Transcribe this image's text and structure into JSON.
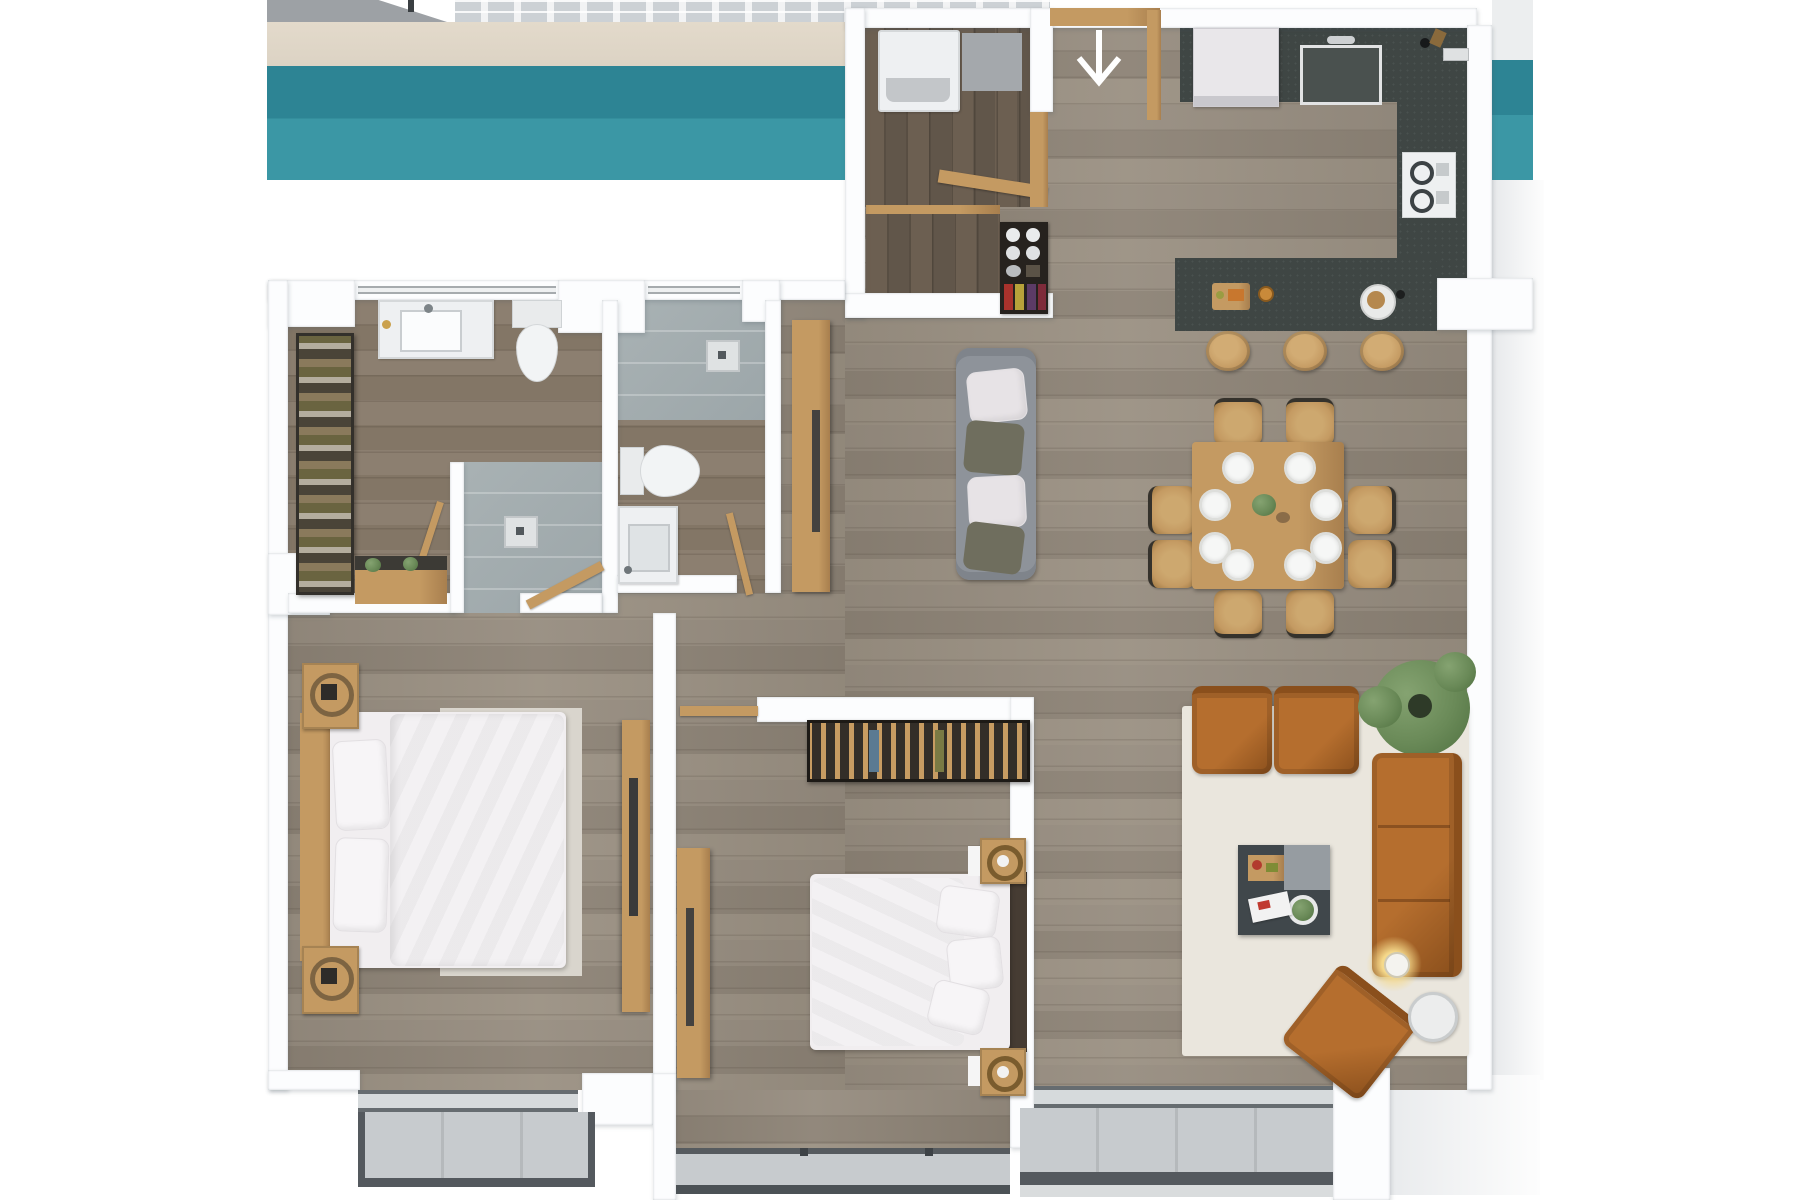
{
  "page": {
    "kind": "3d-apartment-floor-plan-render",
    "visible_text": "",
    "background": "#ffffff"
  },
  "palette": {
    "wall": "#fcfdfe",
    "teal_top": "#2d8494",
    "teal_bottom": "#3b97a5",
    "beige": "#dcd3c4",
    "slab_grey": "#9da1a5",
    "tile_a": "#ccd1d5",
    "tile_b": "#f2f3f4",
    "floor_a": "#968c7f",
    "floor_b": "#8c8275",
    "floor_c": "#9a9082",
    "floor_dark_a": "#6c5f51",
    "floor_dark_b": "#61564a",
    "bath_a": "#8c7f70",
    "bath_b": "#837666",
    "shower": "#a9b2b4",
    "counter": "#3f4644",
    "wood_tan": "#c49a62",
    "wood_tan_dark": "#a87f4e",
    "leather": "#b56e2e",
    "leather_dark": "#8a4f1c",
    "sofa_grey": "#8e939a",
    "cushion_olive": "#6f6e5e",
    "cushion_white": "#e7e3e6",
    "rug_living": "#eae6dd",
    "rug_bed": "#d9d5cd",
    "bedding": "#f1eef0",
    "pillow": "#f7f5f7",
    "fixture": "#eef0f2",
    "fixture_edge": "#d5d8da",
    "balcony": "#c7cbce",
    "frame_dark": "#54595e",
    "glow": "#f5d98b",
    "plant": "#6a8a58",
    "plant_dark": "#4f7040",
    "headboard": "#463c33",
    "closet_dark": "#26221e",
    "appliance": "#e9e7ea",
    "mat_grey": "#a4a8ac",
    "handle_dark": "#44423f",
    "outside_grey": "#e9ebed"
  },
  "entry": {
    "arrow_direction": "down"
  },
  "rooms": [
    {
      "id": "terrace-strip",
      "features": [
        "pool-band-teal",
        "paver-tiles",
        "concrete-slab",
        "sand-strip"
      ]
    },
    {
      "id": "entry-hall",
      "furniture": [
        "door-threshold",
        "down-arrow-marker",
        "corner-cabinet"
      ]
    },
    {
      "id": "laundry-closet",
      "furniture": [
        "washer",
        "floor-mat",
        "door-leaf"
      ]
    },
    {
      "id": "pantry",
      "furniture": [
        "shelf-unit-with-plates-and-jars"
      ]
    },
    {
      "id": "kitchen",
      "furniture": [
        "refrigerator",
        "sink",
        "cooktop",
        "l-shaped-counter",
        "island",
        "cutting-board",
        "plate"
      ],
      "bar_stools": 3
    },
    {
      "id": "dining-area",
      "furniture": [
        "square-table",
        "center-plant"
      ],
      "chairs": 8,
      "place_settings": 8
    },
    {
      "id": "open-lounge",
      "furniture": [
        "grey-two-seat-sofa"
      ]
    },
    {
      "id": "living-room",
      "furniture": [
        "area-rug",
        "armchair",
        "armchair",
        "three-seat-sofa",
        "coffee-table",
        "floor-lamp",
        "rotated-lounge-chair",
        "round-side-table",
        "large-potted-plant"
      ]
    },
    {
      "id": "hallway",
      "furniture": [
        "tall-cabinet"
      ]
    },
    {
      "id": "bathroom-1",
      "furniture": [
        "vanity-sink",
        "toilet",
        "walk-in-shower",
        "shower-drain",
        "glass-partition",
        "open-shoe-shelf",
        "console-with-plants",
        "door-leaf"
      ]
    },
    {
      "id": "bathroom-2",
      "furniture": [
        "shower-area",
        "shower-drain",
        "toilet",
        "sink",
        "door-leaf"
      ]
    },
    {
      "id": "bedroom-1",
      "furniture": [
        "double-bed",
        "headboard",
        "rug",
        "tv-sideboard",
        "door-leaf"
      ],
      "nightstands": 2,
      "pillows": 2
    },
    {
      "id": "bedroom-2",
      "furniture": [
        "double-bed",
        "dark-headboard",
        "open-slatted-closet",
        "sideboard",
        "door-leaf"
      ],
      "nightstands": 2,
      "pillows": 3
    },
    {
      "id": "balcony-1",
      "furniture": [
        "deck-slab",
        "railing-frame"
      ]
    },
    {
      "id": "balcony-2",
      "furniture": [
        "deck-slab",
        "railing-frame"
      ]
    }
  ]
}
